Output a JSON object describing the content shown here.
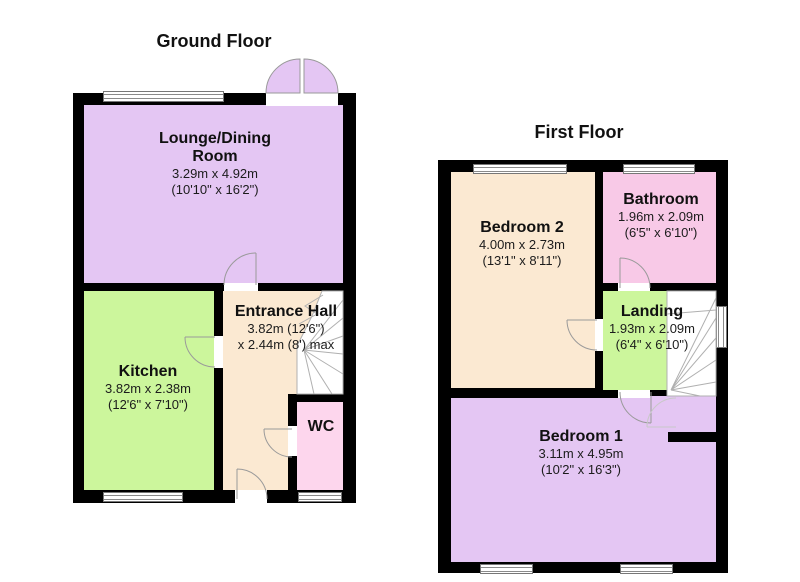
{
  "document_type": "floorplan",
  "colors": {
    "wall": "#000000",
    "purple_room": "#e4c6f3",
    "green_room": "#ccf69c",
    "cream_room": "#fbe9d2",
    "wc_pink": "#fdd6ed",
    "bathroom_pink": "#f8c9e7",
    "stairs_white": "#ffffff",
    "door_arc": "#9a9a9a"
  },
  "ground_floor": {
    "title": "Ground Floor",
    "rooms": {
      "lounge": {
        "name": "Lounge/Dining Room",
        "metric": "3.29m x 4.92m",
        "imperial": "(10'10\" x 16'2\")"
      },
      "kitchen": {
        "name": "Kitchen",
        "metric": "3.82m x 2.38m",
        "imperial": "(12'6\" x 7'10\")"
      },
      "entrance_hall": {
        "name": "Entrance Hall",
        "metric": "3.82m (12'6\")",
        "imperial": "x 2.44m (8') max"
      },
      "wc": {
        "name": "WC"
      }
    }
  },
  "first_floor": {
    "title": "First Floor",
    "rooms": {
      "bedroom2": {
        "name": "Bedroom 2",
        "metric": "4.00m x 2.73m",
        "imperial": "(13'1\" x 8'11\")"
      },
      "bathroom": {
        "name": "Bathroom",
        "metric": "1.96m x 2.09m",
        "imperial": "(6'5\" x 6'10\")"
      },
      "landing": {
        "name": "Landing",
        "metric": "1.93m x 2.09m",
        "imperial": "(6'4\" x 6'10\")"
      },
      "bedroom1": {
        "name": "Bedroom 1",
        "metric": "3.11m x 4.95m",
        "imperial": "(10'2\" x 16'3\")"
      }
    }
  }
}
